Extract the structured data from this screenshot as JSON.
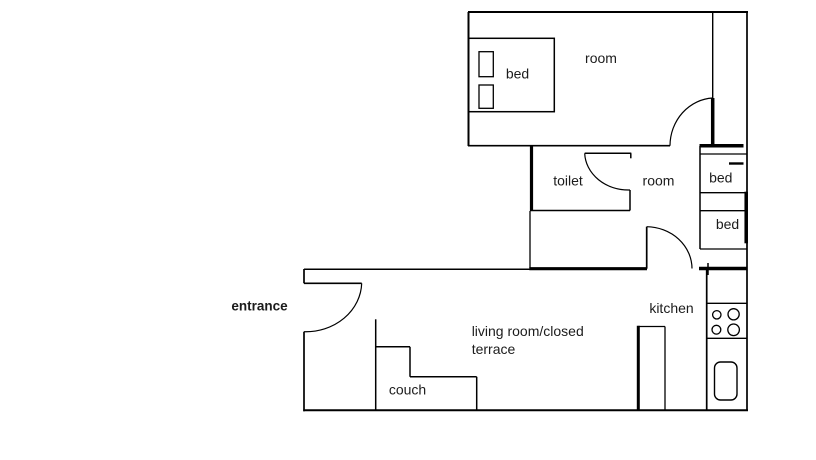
{
  "canvas": {
    "width": 816,
    "height": 460,
    "background_color": "#ffffff",
    "line_color": "#000000",
    "text_color": "#1c1c1c"
  },
  "floorplan": {
    "rooms_named": [
      "room",
      "toilet",
      "room",
      "kitchen",
      "living room/closed terrace"
    ],
    "walls": [
      {
        "name": "top-wall",
        "x1": 468,
        "y1": 12,
        "x2": 748,
        "y2": 12,
        "w": 2
      },
      {
        "name": "right-wall",
        "x1": 747,
        "y1": 12,
        "x2": 747,
        "y2": 411,
        "w": 1.7
      },
      {
        "name": "bedroom-left-wall",
        "x1": 468.5,
        "y1": 12,
        "x2": 468.5,
        "y2": 146,
        "w": 2
      },
      {
        "name": "bedroom-bottom-wall",
        "x1": 468,
        "y1": 145.7,
        "x2": 670,
        "y2": 145.7,
        "w": 1.7
      },
      {
        "name": "shaft-left-wall",
        "x1": 712.7,
        "y1": 12,
        "x2": 712.7,
        "y2": 98,
        "w": 1.4
      },
      {
        "name": "bedroom-door-leaf",
        "x1": 712.7,
        "y1": 98,
        "x2": 712.7,
        "y2": 146,
        "w": 3.5
      },
      {
        "name": "beds-top-wall",
        "x1": 699.5,
        "y1": 145.7,
        "x2": 743.5,
        "y2": 145.7,
        "w": 3.5
      },
      {
        "name": "beds-left-wall",
        "x1": 700,
        "y1": 146,
        "x2": 700,
        "y2": 249,
        "w": 1.5
      },
      {
        "name": "beds-divider-1",
        "x1": 700,
        "y1": 154,
        "x2": 746.5,
        "y2": 154,
        "w": 1.3
      },
      {
        "name": "beds-dash",
        "x1": 729,
        "y1": 163.5,
        "x2": 743.5,
        "y2": 163.5,
        "w": 2.4
      },
      {
        "name": "beds-divider-2",
        "x1": 700,
        "y1": 192.7,
        "x2": 746.5,
        "y2": 192.7,
        "w": 1.3
      },
      {
        "name": "beds-divider-3",
        "x1": 700,
        "y1": 210.7,
        "x2": 746.5,
        "y2": 210.7,
        "w": 1.3
      },
      {
        "name": "beds-bottom",
        "x1": 700,
        "y1": 249,
        "x2": 747.5,
        "y2": 249,
        "w": 1.3
      },
      {
        "name": "beds-right-thick-wall",
        "x1": 746.2,
        "y1": 191.7,
        "x2": 746.2,
        "y2": 243.3,
        "w": 3.5
      },
      {
        "name": "toilet-left-wall",
        "x1": 531.5,
        "y1": 146,
        "x2": 531.5,
        "y2": 211,
        "w": 3.2
      },
      {
        "name": "toilet-bottom-wall",
        "x1": 530.5,
        "y1": 210.5,
        "x2": 630,
        "y2": 210.5,
        "w": 1.5
      },
      {
        "name": "toilet-right-wall",
        "x1": 630,
        "y1": 190,
        "x2": 630,
        "y2": 210.5,
        "w": 1.5
      },
      {
        "name": "toilet-door-leaf",
        "x1": 584.7,
        "y1": 153.3,
        "x2": 631.3,
        "y2": 153.3,
        "w": 1.5
      },
      {
        "name": "toilet-door-jamb",
        "x1": 630.8,
        "y1": 153.3,
        "x2": 630.8,
        "y2": 158.3,
        "w": 1.5
      },
      {
        "name": "corridor-left-wall",
        "x1": 530,
        "y1": 211,
        "x2": 530,
        "y2": 268,
        "w": 1.3
      },
      {
        "name": "corridor-bottom-wall",
        "x1": 529.3,
        "y1": 268.7,
        "x2": 647,
        "y2": 268.7,
        "w": 3.2
      },
      {
        "name": "hallway-top-wall",
        "x1": 304,
        "y1": 269.3,
        "x2": 530,
        "y2": 269.3,
        "w": 1.5
      },
      {
        "name": "hall-door-leaf",
        "x1": 646.7,
        "y1": 226.7,
        "x2": 646.7,
        "y2": 268.7,
        "w": 1.7
      },
      {
        "name": "kitchen-top-wall",
        "x1": 699,
        "y1": 268.5,
        "x2": 747.5,
        "y2": 268.5,
        "w": 3.5
      },
      {
        "name": "kitchen-top-jamb",
        "x1": 708,
        "y1": 263,
        "x2": 708,
        "y2": 275,
        "w": 1.5
      },
      {
        "name": "entrance-wall-upper",
        "x1": 304,
        "y1": 269,
        "x2": 304,
        "y2": 283.3,
        "w": 1.7
      },
      {
        "name": "entrance-door-leaf",
        "x1": 304,
        "y1": 283.3,
        "x2": 361.7,
        "y2": 283.3,
        "w": 1.7
      },
      {
        "name": "entrance-wall-lower",
        "x1": 304,
        "y1": 331.7,
        "x2": 304,
        "y2": 411.3,
        "w": 1.7
      },
      {
        "name": "bottom-wall",
        "x1": 303.3,
        "y1": 410.3,
        "x2": 748,
        "y2": 410.3,
        "w": 2
      },
      {
        "name": "couch-back-line",
        "x1": 375.7,
        "y1": 319.3,
        "x2": 375.7,
        "y2": 410,
        "w": 1.5
      },
      {
        "name": "couch-top-edge",
        "x1": 375.7,
        "y1": 346.8,
        "x2": 410,
        "y2": 346.8,
        "w": 1.5
      },
      {
        "name": "couch-step-vertical",
        "x1": 410,
        "y1": 346.8,
        "x2": 410,
        "y2": 376.8,
        "w": 1.5
      },
      {
        "name": "couch-mid-edge",
        "x1": 410,
        "y1": 376.8,
        "x2": 476.7,
        "y2": 376.8,
        "w": 1.5
      },
      {
        "name": "couch-right-edge",
        "x1": 476.7,
        "y1": 376.8,
        "x2": 476.7,
        "y2": 410,
        "w": 1.5
      },
      {
        "name": "divider-thick-wall",
        "x1": 638.3,
        "y1": 325.7,
        "x2": 638.3,
        "y2": 410,
        "w": 3
      },
      {
        "name": "divider-top-edge",
        "x1": 638.3,
        "y1": 326.5,
        "x2": 665,
        "y2": 326.5,
        "w": 1.3
      },
      {
        "name": "divider-right-edge",
        "x1": 665,
        "y1": 326.5,
        "x2": 665,
        "y2": 410,
        "w": 1.3
      },
      {
        "name": "counter-left-wall",
        "x1": 706.7,
        "y1": 268.5,
        "x2": 706.7,
        "y2": 410.3,
        "w": 1.7
      },
      {
        "name": "counter-divider-1",
        "x1": 706.7,
        "y1": 303.3,
        "x2": 747,
        "y2": 303.3,
        "w": 1.3
      },
      {
        "name": "counter-divider-2",
        "x1": 706.7,
        "y1": 338.3,
        "x2": 747,
        "y2": 338.3,
        "w": 1.3
      }
    ],
    "door_arcs": [
      {
        "name": "bedroom-door-arc",
        "d": "M 670 145.7 A 45 48 0 0 1 712.7 98"
      },
      {
        "name": "toilet-door-arc",
        "d": "M 584.7 153.3 A 44 38 0 0 0 630 190"
      },
      {
        "name": "hall-door-arc",
        "d": "M 646.7 226.7 A 46 42 0 0 1 692 268.5"
      },
      {
        "name": "entrance-door-arc",
        "d": "M 361.7 283.3 A 56 50 0 0 1 304 331.7"
      }
    ],
    "furniture_rects": [
      {
        "name": "bed-outline",
        "x": 468.3,
        "y": 38.3,
        "w": 86,
        "h": 73.4,
        "rx": 0,
        "sw": 1.5
      },
      {
        "name": "pillow-1",
        "x": 479,
        "y": 51.7,
        "w": 14.3,
        "h": 25,
        "rx": 0,
        "sw": 1.3
      },
      {
        "name": "pillow-2",
        "x": 479,
        "y": 85,
        "w": 14.3,
        "h": 23.3,
        "rx": 0,
        "sw": 1.3
      },
      {
        "name": "sink-basin",
        "x": 714.5,
        "y": 362,
        "w": 22.5,
        "h": 38,
        "rx": 6,
        "sw": 1.4
      }
    ],
    "stove_burners": [
      {
        "name": "burner-small-top",
        "cx": 716.8,
        "cy": 314.8,
        "r": 4.2
      },
      {
        "name": "burner-large-top",
        "cx": 733.6,
        "cy": 314.3,
        "r": 5.6
      },
      {
        "name": "burner-small-bottom",
        "cx": 716.4,
        "cy": 329.7,
        "r": 4.4
      },
      {
        "name": "burner-large-bottom",
        "cx": 733.6,
        "cy": 329.8,
        "r": 5.8
      }
    ],
    "labels": [
      {
        "name": "label-bed-main",
        "text": "bed",
        "x": 517.5,
        "y": 78.5,
        "anchor": "middle",
        "size": 14,
        "bold": false
      },
      {
        "name": "label-room-top",
        "text": "room",
        "x": 601,
        "y": 63,
        "anchor": "middle",
        "size": 14,
        "bold": false
      },
      {
        "name": "label-toilet",
        "text": "toilet",
        "x": 568,
        "y": 185.5,
        "anchor": "middle",
        "size": 14,
        "bold": false
      },
      {
        "name": "label-room-hall",
        "text": "room",
        "x": 658.5,
        "y": 185.5,
        "anchor": "middle",
        "size": 14,
        "bold": false
      },
      {
        "name": "label-bed-1",
        "text": "bed",
        "x": 720.8,
        "y": 182.5,
        "anchor": "middle",
        "size": 14,
        "bold": false
      },
      {
        "name": "label-bed-2",
        "text": "bed",
        "x": 727.5,
        "y": 229,
        "anchor": "middle",
        "size": 14,
        "bold": false
      },
      {
        "name": "label-entrance",
        "text": "entrance",
        "x": 259.5,
        "y": 310.5,
        "anchor": "middle",
        "size": 13.5,
        "bold": true
      },
      {
        "name": "label-kitchen",
        "text": "kitchen",
        "x": 671.5,
        "y": 313,
        "anchor": "middle",
        "size": 14,
        "bold": false
      },
      {
        "name": "label-living-line1",
        "text": "living room/closed",
        "x": 471.7,
        "y": 336,
        "anchor": "start",
        "size": 14,
        "bold": false
      },
      {
        "name": "label-living-line2",
        "text": "terrace",
        "x": 471.7,
        "y": 354,
        "anchor": "start",
        "size": 14,
        "bold": false
      },
      {
        "name": "label-couch",
        "text": "couch",
        "x": 407.5,
        "y": 394.5,
        "anchor": "middle",
        "size": 14,
        "bold": false
      }
    ]
  }
}
